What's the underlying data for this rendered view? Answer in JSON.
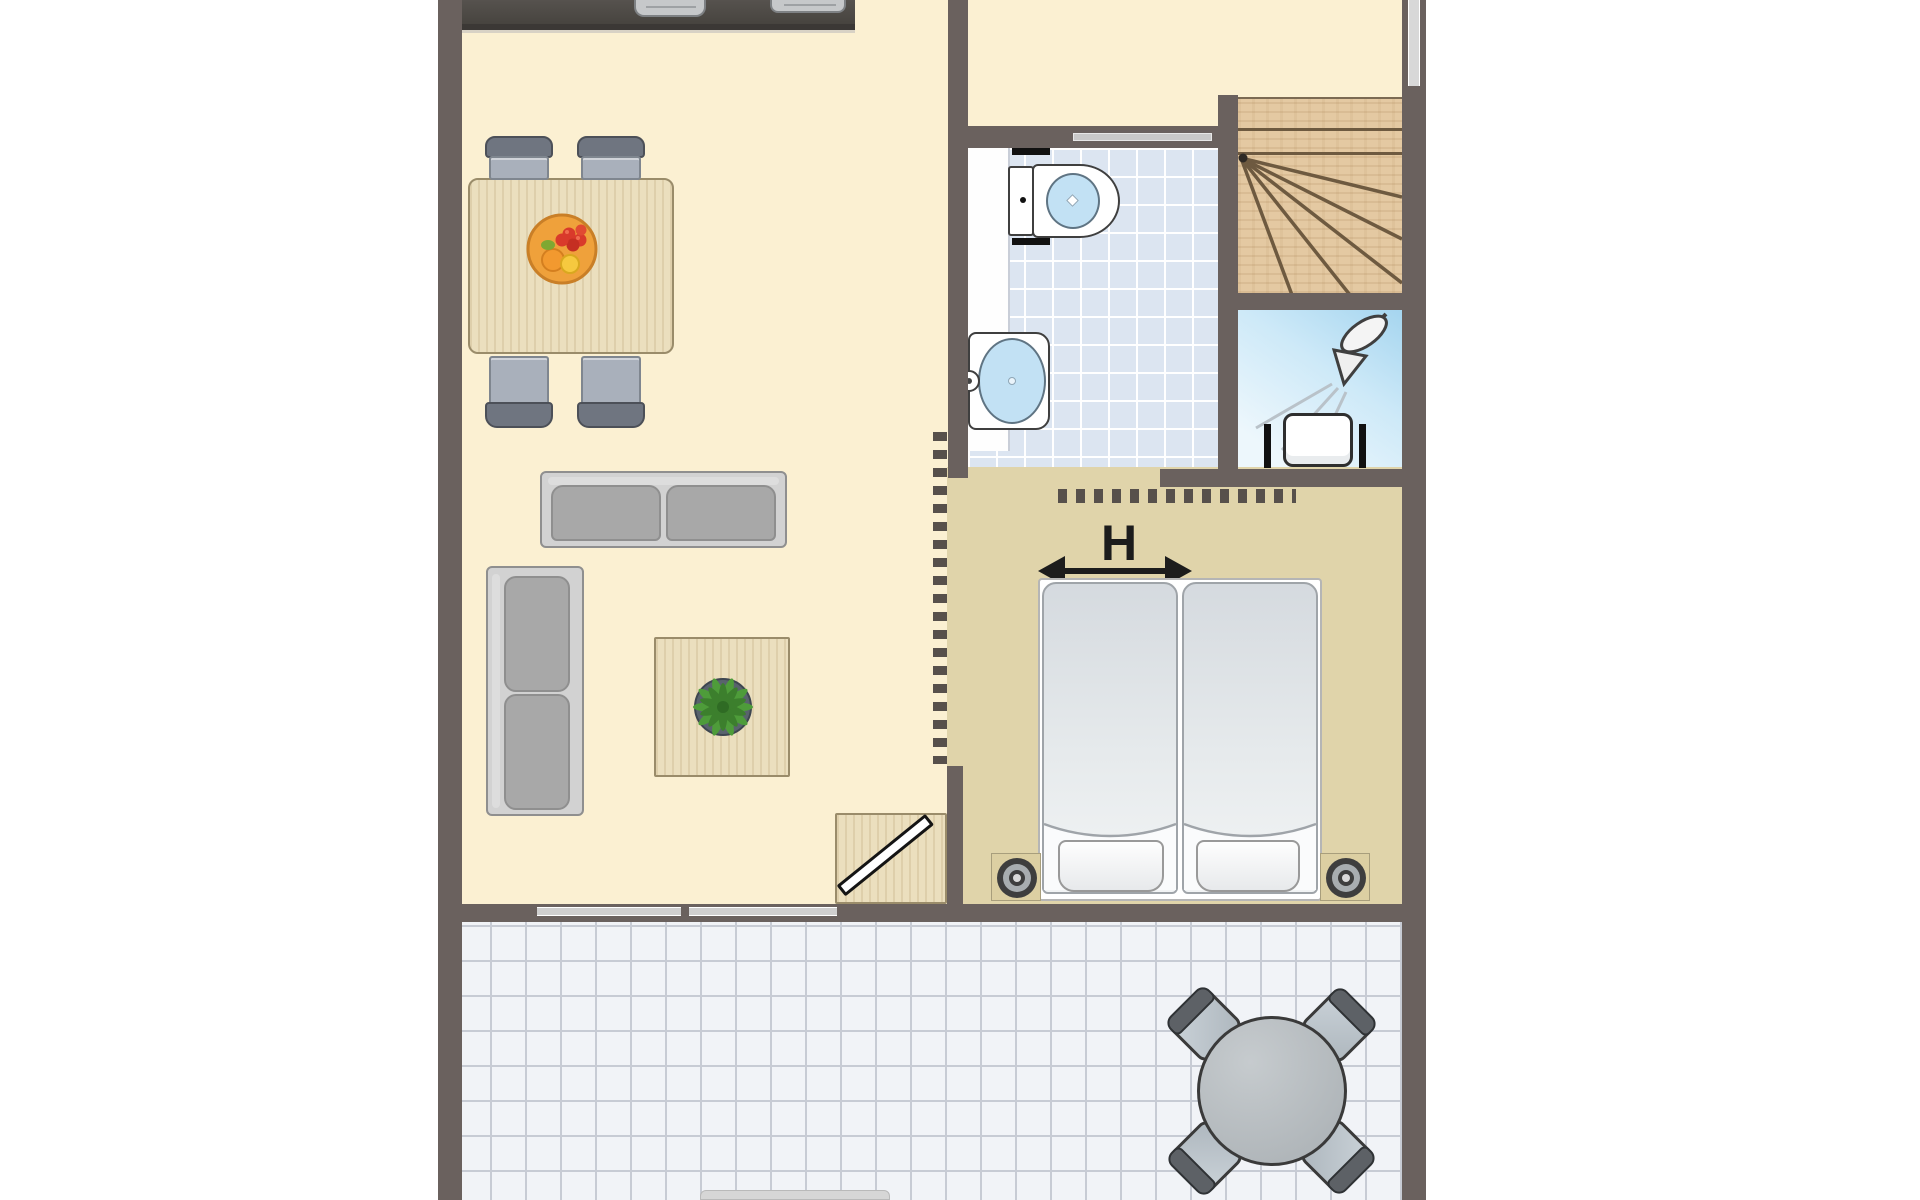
{
  "bedroom": {
    "h_label": "H"
  },
  "icons": {
    "shower_head": "shower-head-icon",
    "plant": "potted-plant-icon",
    "fruit_bowl": "fruit-bowl-icon",
    "door_swing": "open-door-icon"
  },
  "colors": {
    "wall": "#6A615E",
    "cream": "#FBF0D2",
    "tan": "#E0D4AA",
    "bathtile": "#DCE5F1",
    "bathgrid": "#FFFFFF",
    "shower1": "#A5D5EF",
    "shower2": "#EDF7FC",
    "woodstairs": "#E4C9A2",
    "woodlite": "#EBDFBE",
    "woodline": "#9A8C6A",
    "stairline": "#6E5A40",
    "terrace": "#F1F3F7",
    "tgrid": "#C7CBD4",
    "winbar": "#CFCFCF",
    "counter2": "#3B3835",
    "sofaframe": "#D2D2D2",
    "sofacushion": "#A8A8A8",
    "sofaline": "#8F8F8F",
    "chairback": "#6F7580",
    "chairseat": "#A9B0BB",
    "mat1": "#D5DADF",
    "mat2": "#F2F4F5",
    "ink": "#1C1C1C",
    "outline": "#3F3F3F",
    "fixture": "#C6C8CA",
    "blue": "#C2E1F4",
    "rtable1": "#C6CBCE",
    "rtable2": "#A9AFB3",
    "tchair1": "#CBD3D9",
    "tchair2": "#AEB7BE",
    "dash": "#57504B",
    "sill": "#D8D8D8",
    "plantpot": "#59636D",
    "plantgreen": "#4E9C3A"
  }
}
